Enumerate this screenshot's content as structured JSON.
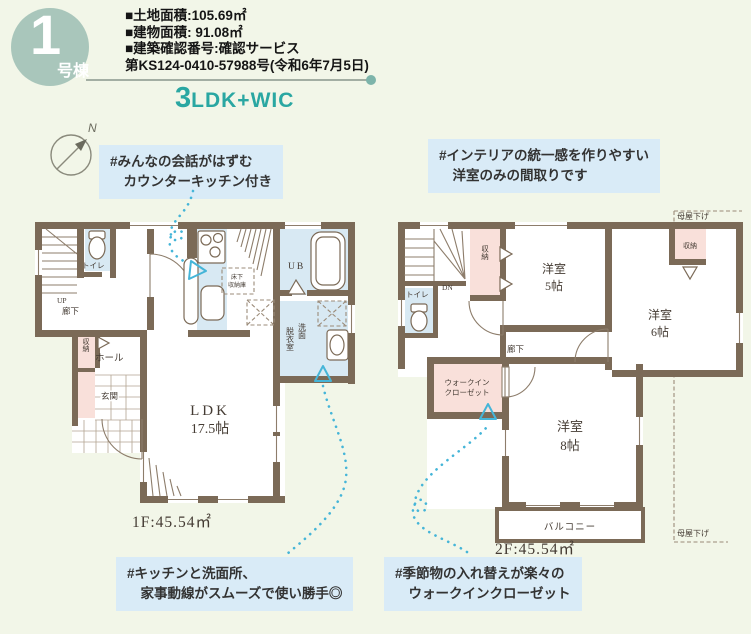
{
  "badge": {
    "number": "1",
    "suffix": "号棟"
  },
  "header": {
    "lines": [
      "■土地面積:105.69㎡",
      "■建物面積: 91.08㎡",
      "■建築確認番号:確認サービス",
      "第KS124-0410-57988号(令和6年7月5日)"
    ],
    "plan_type_number": "3",
    "plan_type_rest": "LDK+WIC"
  },
  "compass": {
    "north": "N"
  },
  "colors": {
    "accent_teal": "#2aa7a2",
    "badge_green": "#a9c6bb",
    "callout_blue": "#d9ebf7",
    "wall_brown": "#7b6a57",
    "wet_blue": "#d8e9f3",
    "storage_pink": "#f9e0da",
    "dotted_teal": "#45b5d8",
    "page_bg": "#f2f6e8"
  },
  "callouts": {
    "kitchen": {
      "line1": "#みんなの会話がはずむ",
      "line2": "　カウンターキッチン付き"
    },
    "interior": {
      "line1": "#インテリアの統一感を作りやすい",
      "line2": "　洋室のみの間取りです"
    },
    "housework": {
      "line1": "#キッチンと洗面所、",
      "line2": "　家事動線がスムーズで使い勝手◎"
    },
    "wic": {
      "line1": "#季節物の入れ替えが楽々の",
      "line2": "　ウォークインクローゼット"
    }
  },
  "floor1": {
    "area": "1F:45.54㎡",
    "labels": {
      "up": "UP",
      "toilet": "トイレ",
      "hallway": "廊下",
      "storage": "収納",
      "hall": "ホール",
      "entrance": "玄関",
      "ub": "UB",
      "underfloor1": "床下",
      "underfloor2": "収納庫",
      "wash1": "洗面",
      "wash2": "脱衣室",
      "ldk": "LDK",
      "ldk_size": "17.5帖"
    }
  },
  "floor2": {
    "area": "2F:45.54㎡",
    "labels": {
      "dn": "DN",
      "toilet": "トイレ",
      "storage_a": "収納",
      "room5": "洋室",
      "room5_size": "5帖",
      "room6": "洋室",
      "room6_size": "6帖",
      "storage_b": "収納",
      "hallway": "廊下",
      "wic1": "ウォークイン",
      "wic2": "クローゼット",
      "room8": "洋室",
      "room8_size": "8帖",
      "balcony": "バルコニー",
      "eaves_top": "母屋下げ",
      "eaves_bottom": "母屋下げ"
    }
  }
}
